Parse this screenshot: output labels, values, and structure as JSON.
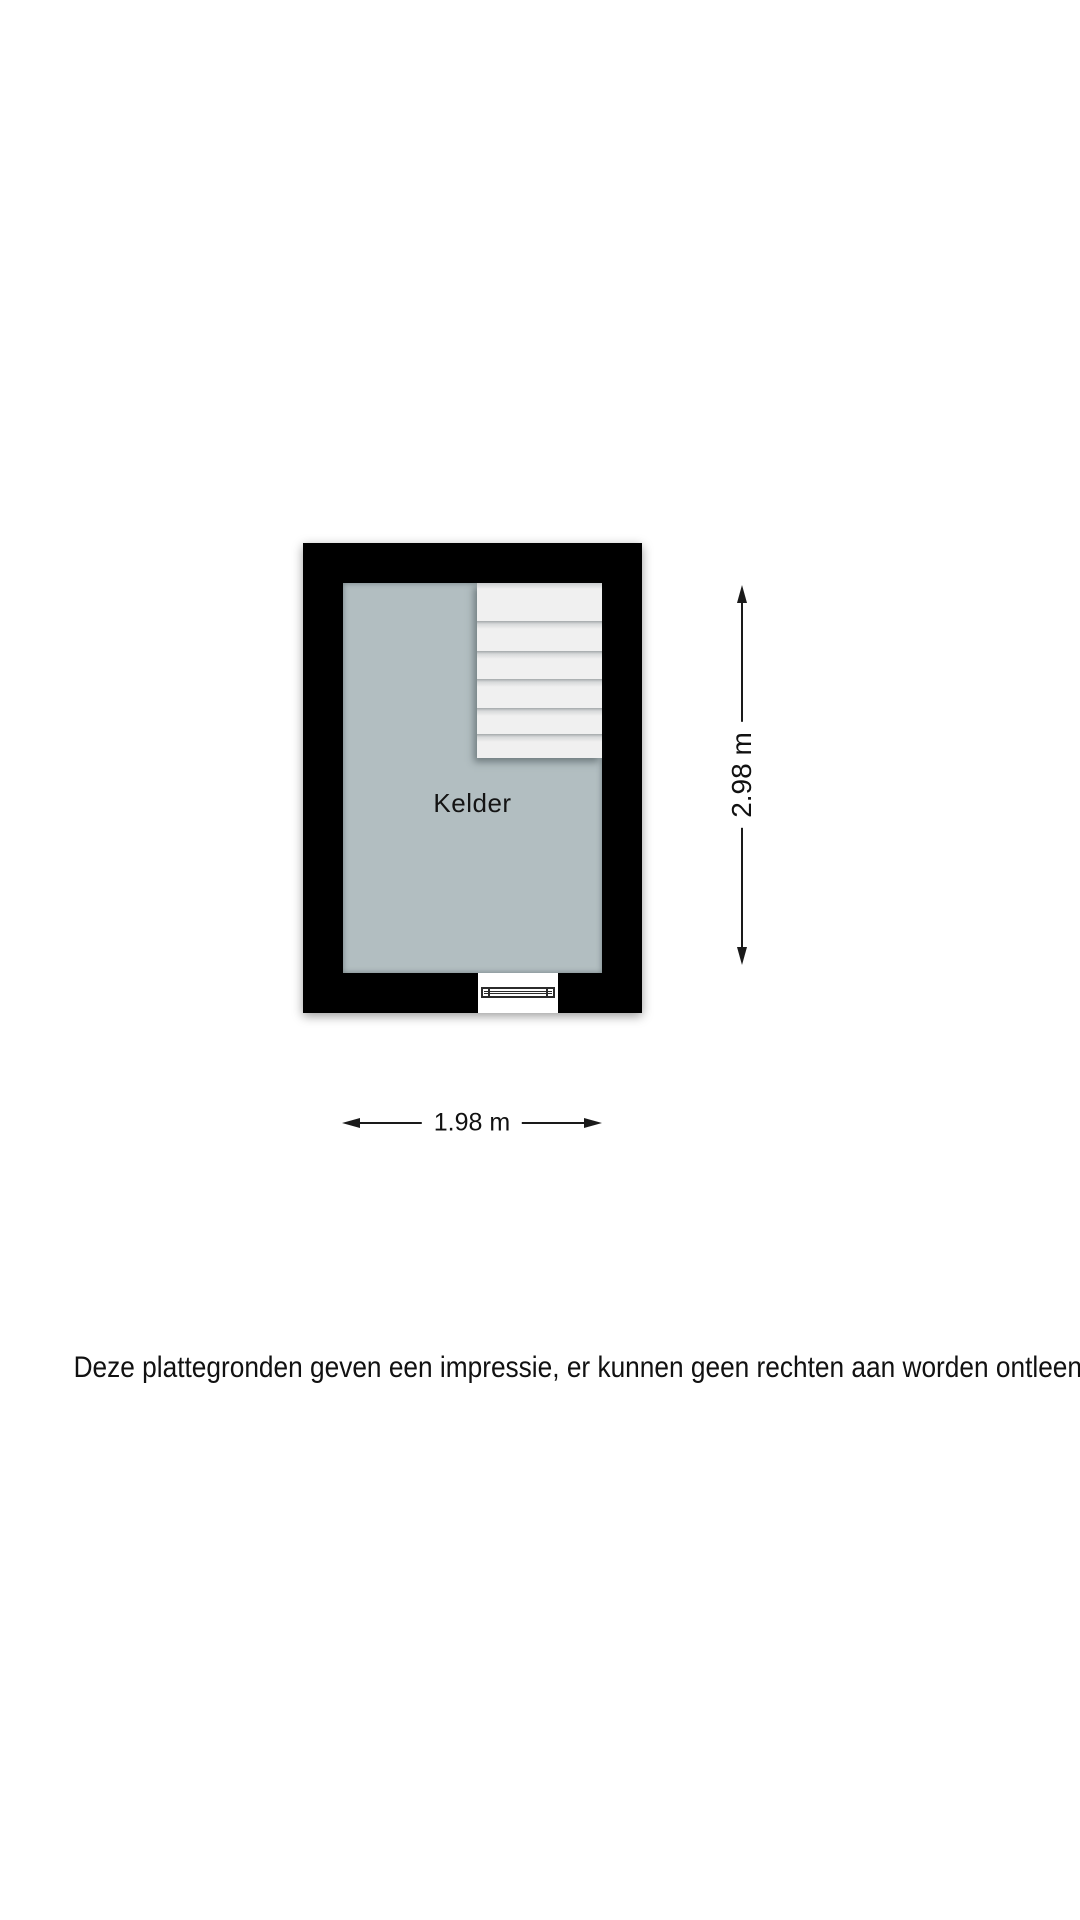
{
  "plan": {
    "room_label": "Kelder",
    "dim_vertical": "2.98 m",
    "dim_horizontal": "1.98 m",
    "stairs": {
      "tread_count": 6
    },
    "window": {
      "symbol": "window-symbol"
    }
  },
  "footer": {
    "disclaimer": "Deze plattegronden geven een impressie, er kunnen geen rechten aan worden ontleend."
  },
  "colors": {
    "wall": "#000000",
    "floor": "#b2bec1",
    "stairs": "#f0f0f0",
    "dimension_line": "#1a1a1a",
    "text": "#111111",
    "background": "#ffffff"
  }
}
